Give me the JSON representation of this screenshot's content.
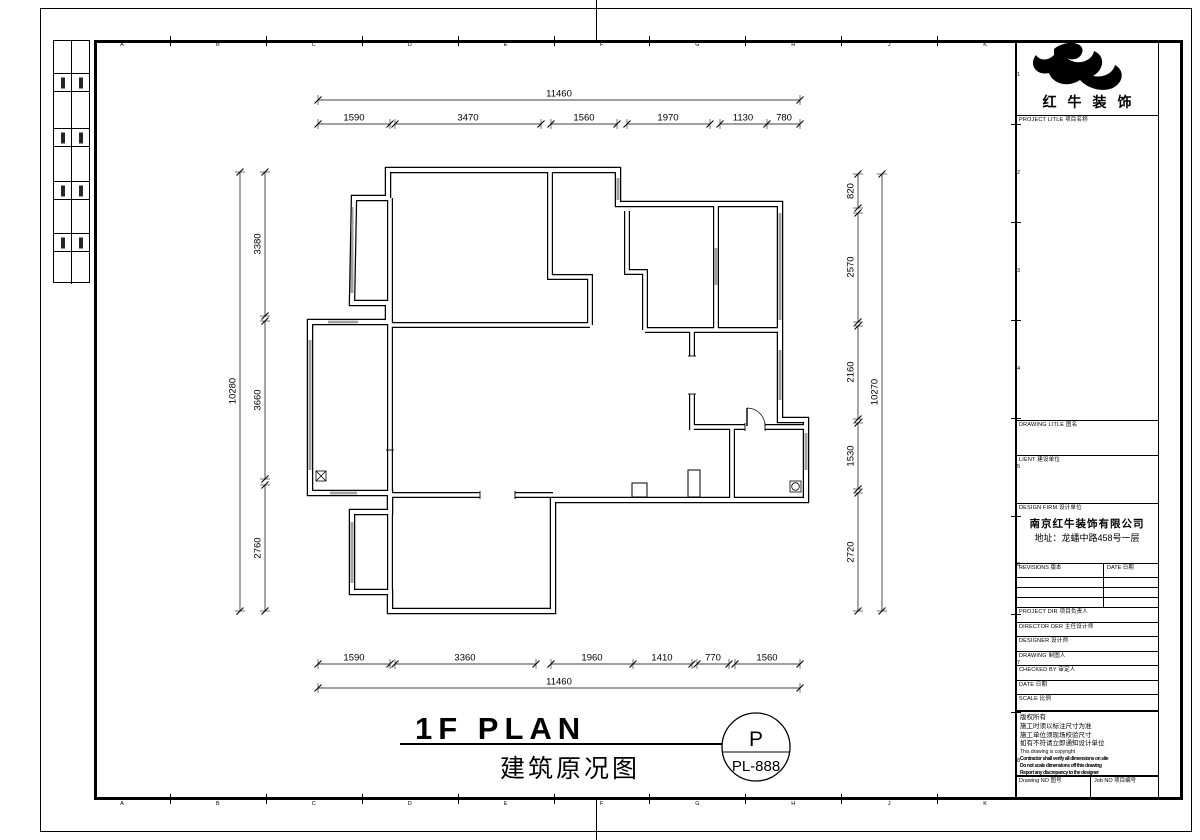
{
  "sheet": {
    "grid_letters": [
      "A",
      "B",
      "C",
      "D",
      "E",
      "F",
      "G",
      "H",
      "J",
      "K"
    ],
    "grid_numbers": [
      "1",
      "2",
      "3",
      "4",
      "5",
      "6",
      "7",
      "8"
    ]
  },
  "title_block": {
    "brand": "红牛装饰",
    "project_title_label": "PROJECT LITLE  项目名称",
    "drawing_title_label": "DRAWING LITLE  图名",
    "client_label": "LIENT  建设单位",
    "design_firm_label": "DESIGN FIRM  设计单位",
    "firm_name": "南京红牛装饰有限公司",
    "firm_address": "地址：龙蟠中路458号一层",
    "revisions_label": "REVISIONS  版本",
    "revision_date_label": "DATE  日期",
    "project_dir_label": "PROJECT DIR  项目负责人",
    "director_label": "DIRECTOR DER  主任设计师",
    "designer_label": "DESIGNER  设计师",
    "drafter_label": "DRAWING  制图人",
    "checked_label": "CHECKED BY  审定人",
    "date_label": "DATE  日期",
    "scale_label": "SCALE  比例",
    "notes": [
      "版权所有",
      "施工时须以标注尺寸为准",
      "施工单位须现场校验尺寸",
      "如有不符请立即通知设计单位",
      "This drawing is copyright",
      "Contractor shall verify all dimensions on site",
      "Do not scale dimensions off this drawing",
      "Report any discrepancy to the designer"
    ],
    "drawing_no_label": "Drawing NO  图号",
    "job_no_label": "Job NO  项目编号"
  },
  "footer": {
    "title_en": "1F PLAN",
    "title_cn": "建筑原况图",
    "stamp_letter": "P",
    "stamp_number": "PL-888"
  },
  "plan": {
    "dims": {
      "top_overall": "11460",
      "top_segments": [
        "1590",
        "3470",
        "1560",
        "1970",
        "1130",
        "780"
      ],
      "bottom_segments": [
        "1590",
        "3360",
        "1960",
        "1410",
        "770",
        "1560"
      ],
      "bottom_overall": "11460",
      "left_overall": "10280",
      "left_segments": [
        "3380",
        "3660",
        "2760"
      ],
      "right_segments": [
        "820",
        "2570",
        "2160",
        "1530",
        "2720"
      ],
      "right_overall": "10270"
    },
    "ink": "#000000"
  }
}
